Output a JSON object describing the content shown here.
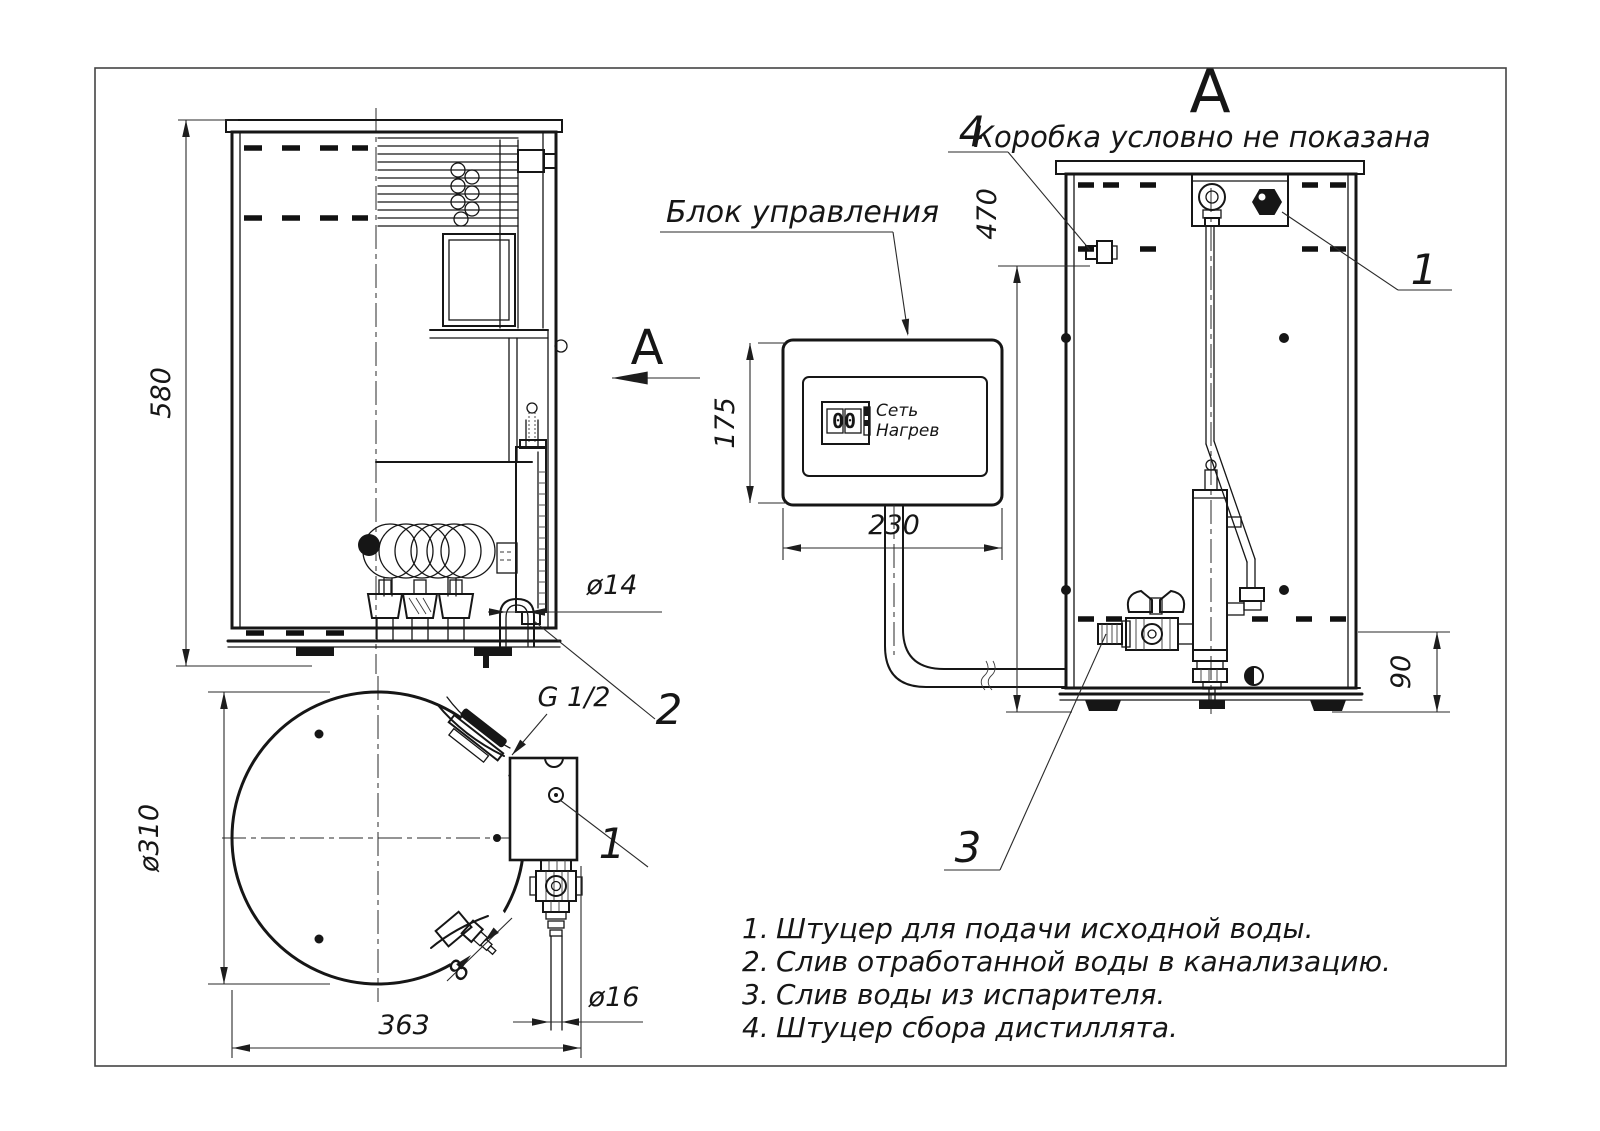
{
  "section_view": {
    "view_letter": "А",
    "dim_height": "580",
    "dim_drain": "ø14",
    "callout_sewer_drain": "2"
  },
  "bottom_view": {
    "dim_diameter": "ø310",
    "dim_width": "363",
    "dim_tube": "ø16",
    "dim_barb": "8",
    "thread_label": "G 1/2",
    "callout_supply": "1"
  },
  "control_box": {
    "label": "Блок управления",
    "dim_height": "175",
    "dim_width": "230",
    "display_digits": "00",
    "indicator_power": "Сеть",
    "indicator_heating": "Нагрев"
  },
  "front_view": {
    "view_label": "А",
    "subtitle": "Коробка условно не показана",
    "dim_height": "470",
    "dim_base_height": "90",
    "callout_distillate": "4",
    "callout_supply": "1",
    "callout_evaporator_drain": "3"
  },
  "notes": [
    {
      "num": "1.",
      "text": "Штуцер для подачи исходной воды."
    },
    {
      "num": "2.",
      "text": "Слив отработанной воды в канализацию."
    },
    {
      "num": "3.",
      "text": "Слив воды из испарителя."
    },
    {
      "num": "4.",
      "text": "Штуцер сбора дистиллята."
    }
  ]
}
